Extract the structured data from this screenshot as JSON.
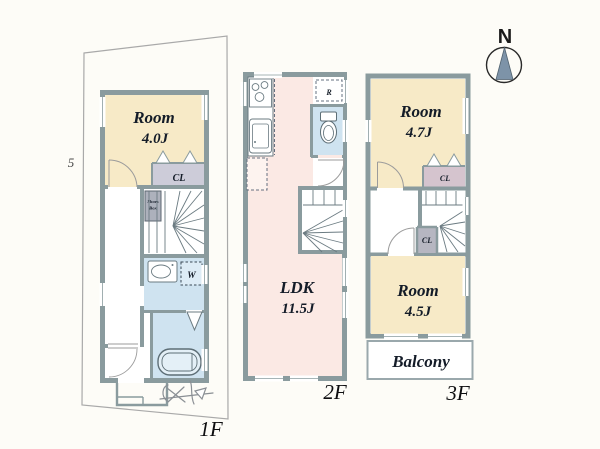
{
  "document": {
    "kind": "house-floor-plan"
  },
  "compass": {
    "north_label": "N"
  },
  "margin_fragment": "5",
  "floor_1": {
    "label": "1F",
    "room": {
      "name": "Room",
      "size": "4.0J"
    },
    "closet_label": "CL",
    "shoes_box": {
      "line1": "Shoes",
      "line2": "Box"
    },
    "washer_label": "W"
  },
  "floor_2": {
    "label": "2F",
    "ldk": {
      "name": "LDK",
      "size": "11.5J"
    },
    "refrigerator_label": "R"
  },
  "floor_3": {
    "label": "3F",
    "room_north": {
      "name": "Room",
      "size": "4.7J"
    },
    "closet_north_label": "CL",
    "closet_mid_label": "CL",
    "room_south": {
      "name": "Room",
      "size": "4.5J"
    },
    "balcony_label": "Balcony"
  },
  "colors": {
    "wall": "#8a9b9e",
    "room_tatami": "#f7eac7",
    "ldk_pink": "#fbe9e4",
    "wet_area_blue": "#cfe3f0",
    "closet_lavender": "#cdccd9",
    "closet_pink": "#d5c4ce",
    "closet_gray": "#b6b6c1",
    "shoes_box_gray": "#adb1bc",
    "compass_needle": "#7d93a8"
  }
}
